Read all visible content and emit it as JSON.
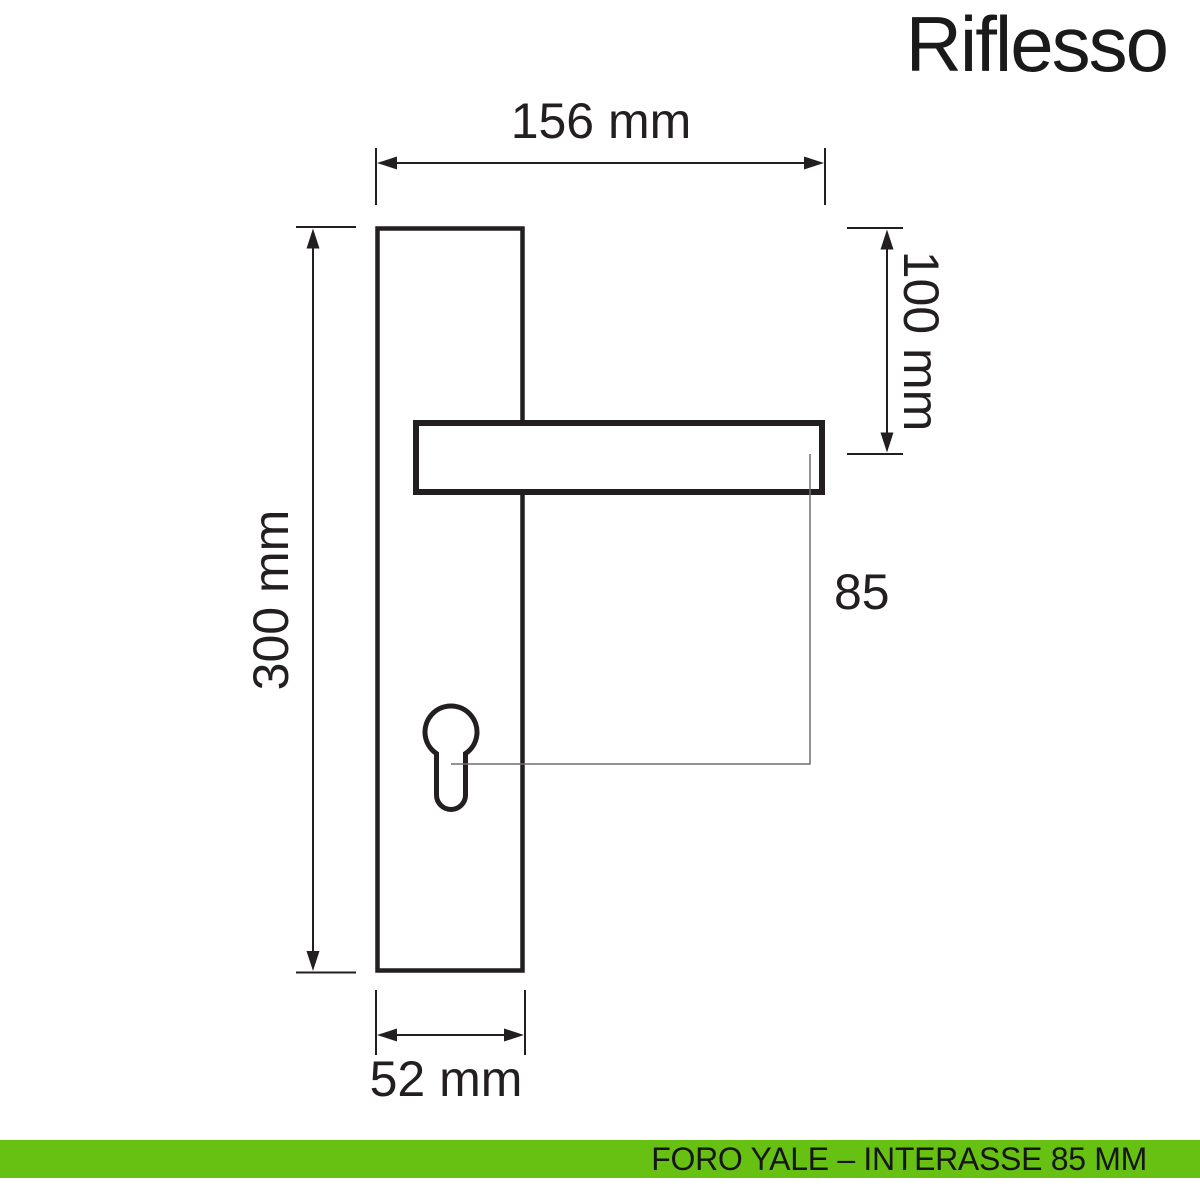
{
  "product": {
    "name": "Riflesso"
  },
  "diagram": {
    "dimensions": {
      "total_width": "156 mm",
      "plate_height": "300 mm",
      "top_to_handle_axis": "100 mm",
      "plate_width": "52 mm",
      "handle_to_cylinder_interaxis": "85"
    }
  },
  "footer": {
    "text": "FORO YALE – INTERASSE 85 MM"
  },
  "colors": {
    "outline": "#231f20",
    "leader_line": "#6d6e71",
    "footer_background": "#67c112",
    "footer_text": "#161616",
    "title_text": "#1a1a1a"
  }
}
